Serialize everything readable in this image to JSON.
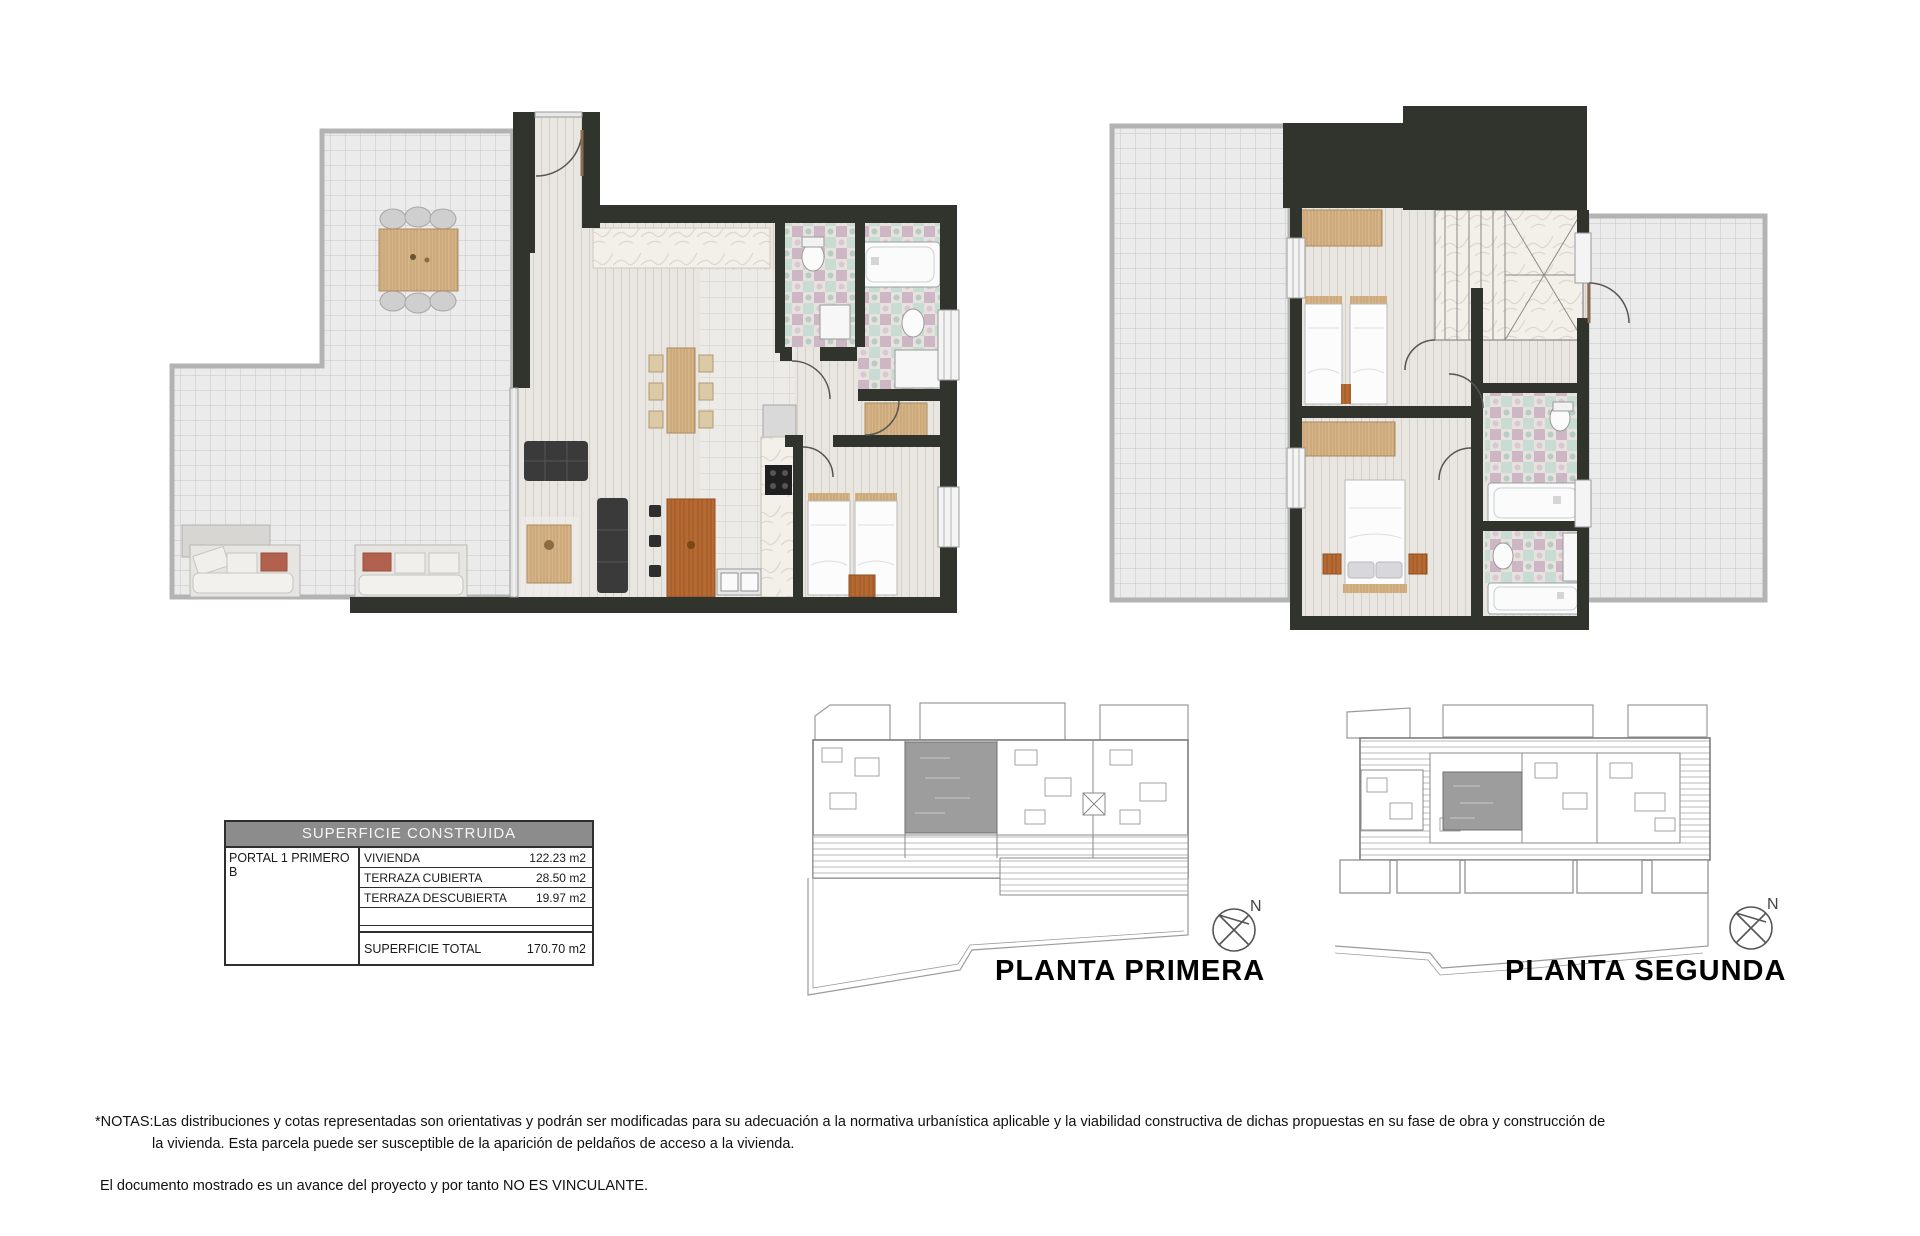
{
  "area_table": {
    "title": "SUPERFICIE CONSTRUIDA",
    "unit_label": "PORTAL 1 PRIMERO B",
    "rows": [
      {
        "label": "VIVIENDA",
        "value": "122.23 m2"
      },
      {
        "label": "TERRAZA CUBIERTA",
        "value": "28.50 m2"
      },
      {
        "label": "TERRAZA DESCUBIERTA",
        "value": "19.97 m2"
      }
    ],
    "total": {
      "label": "SUPERFICIE TOTAL",
      "value": "170.70 m2"
    }
  },
  "site_plans": [
    {
      "label": "PLANTA PRIMERA",
      "compass": "N"
    },
    {
      "label": "PLANTA SEGUNDA",
      "compass": "N"
    }
  ],
  "notes": {
    "line1": "*NOTAS:Las distribuciones y cotas representadas son orientativas y podrán ser modificadas para su adecuación a la normativa urbanística aplicable y la viabilidad constructiva de dichas propuestas en su fase de obra y construcción de",
    "line2": "la vivienda. Esta parcela puede ser susceptible de la aparición de peldaños de acceso a la vivienda.",
    "line3": "El documento mostrado es un avance del proyecto y por tanto NO ES VINCULANTE."
  },
  "colors": {
    "wall": "#30342c",
    "terrace_tile": "#ebebeb",
    "plank_floor": "#e9e5e0",
    "wood": "#d6b488",
    "island_wood": "#b66a33",
    "mosaic_teal": "#c9dcd4",
    "mosaic_pink": "#cdb7c4",
    "table_header_bg": "#8c8c8c"
  }
}
